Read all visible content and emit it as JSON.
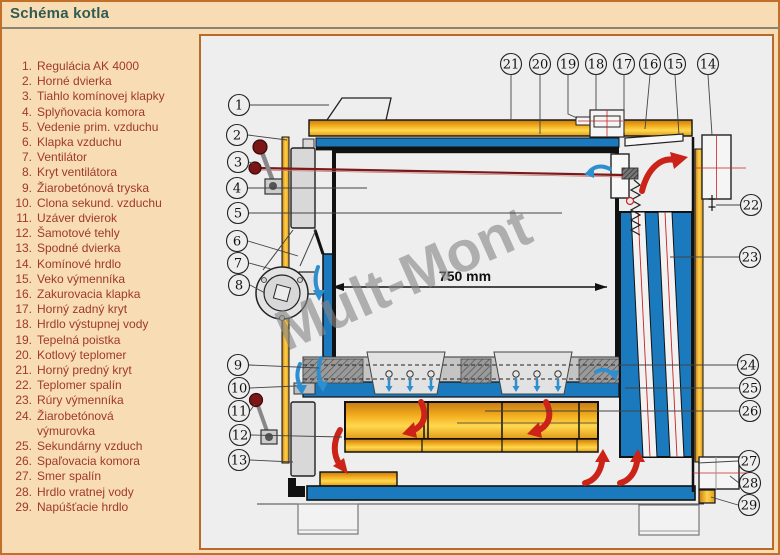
{
  "page": {
    "title": "Schéma kotla"
  },
  "parts": {
    "items": [
      "Regulácia AK 4000",
      "Horné dvierka",
      "Tiahlo komínovej klapky",
      "Splyňovacia komora",
      "Vedenie prim. vzduchu",
      "Klapka vzduchu",
      "Ventilátor",
      "Kryt ventilátora",
      "Žiarobetónová tryska",
      "Clona sekund. vzduchu",
      "Uzáver dvierok",
      "Šamotové tehly",
      "Spodné dvierka",
      "Komínové hrdlo",
      "Veko výmenníka",
      "Zakurovacia klapka",
      "Horný zadný kryt",
      "Hrdlo výstupnej vody",
      "Tepelná poistka",
      "Kotlový teplomer",
      "Horný predný kryt",
      "Teplomer spalín",
      "Rúry výmenníka",
      "Žiarobetónová výmurovka",
      "Sekundárny vzduch",
      "Spaľovacia komora",
      "Smer spalín",
      "Hrdlo vratnej vody",
      "Napúšťacie hrdlo"
    ]
  },
  "diagram": {
    "dimension_label": "750 mm",
    "watermark": "Mult-Mont",
    "callouts": [
      {
        "n": "1",
        "x": 40,
        "y": 71
      },
      {
        "n": "2",
        "x": 38,
        "y": 101
      },
      {
        "n": "3",
        "x": 39,
        "y": 128
      },
      {
        "n": "4",
        "x": 38,
        "y": 154
      },
      {
        "n": "5",
        "x": 39,
        "y": 179
      },
      {
        "n": "6",
        "x": 38,
        "y": 207
      },
      {
        "n": "7",
        "x": 39,
        "y": 229
      },
      {
        "n": "8",
        "x": 40,
        "y": 251
      },
      {
        "n": "9",
        "x": 39,
        "y": 331
      },
      {
        "n": "10",
        "x": 40,
        "y": 354
      },
      {
        "n": "11",
        "x": 40,
        "y": 377
      },
      {
        "n": "12",
        "x": 41,
        "y": 401
      },
      {
        "n": "13",
        "x": 40,
        "y": 426
      },
      {
        "n": "14",
        "x": 509,
        "y": 30
      },
      {
        "n": "15",
        "x": 476,
        "y": 30
      },
      {
        "n": "16",
        "x": 451,
        "y": 30
      },
      {
        "n": "17",
        "x": 425,
        "y": 30
      },
      {
        "n": "18",
        "x": 397,
        "y": 30
      },
      {
        "n": "19",
        "x": 369,
        "y": 30
      },
      {
        "n": "20",
        "x": 341,
        "y": 30
      },
      {
        "n": "21",
        "x": 312,
        "y": 30
      },
      {
        "n": "22",
        "x": 552,
        "y": 171
      },
      {
        "n": "23",
        "x": 551,
        "y": 223
      },
      {
        "n": "24",
        "x": 549,
        "y": 331
      },
      {
        "n": "25",
        "x": 551,
        "y": 354
      },
      {
        "n": "26",
        "x": 551,
        "y": 377
      },
      {
        "n": "27",
        "x": 550,
        "y": 427
      },
      {
        "n": "28",
        "x": 551,
        "y": 449
      },
      {
        "n": "29",
        "x": 550,
        "y": 471
      }
    ]
  },
  "colors": {
    "page_bg": "#F8DCB4",
    "page_border": "#C07028",
    "title": "#2F5B52",
    "list_text": "#A03A28",
    "panel_bg": "#EEEEEE",
    "water_blue": "#1B79BE",
    "insulation_gold": "#E8A81E",
    "flue_red": "#CC2319",
    "air_blue": "#2E8FD0"
  }
}
